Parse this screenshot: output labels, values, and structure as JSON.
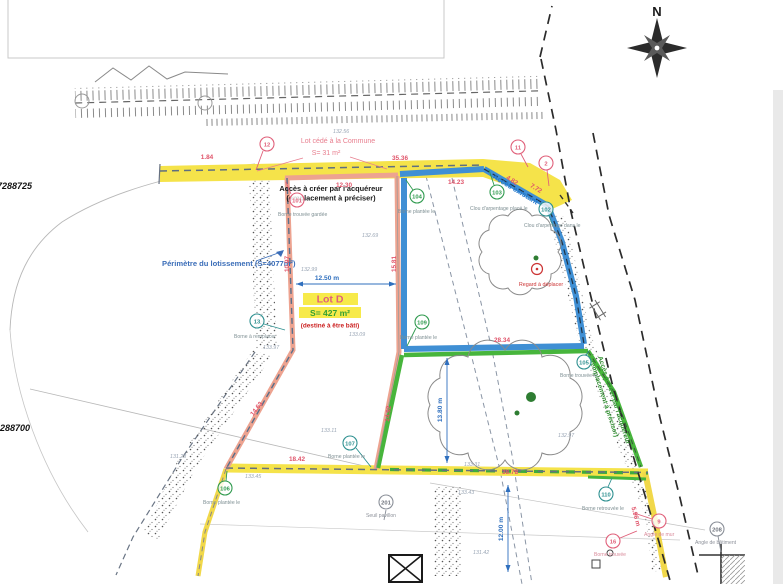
{
  "compass": {
    "north_label": "N"
  },
  "coordinates": {
    "top": "7288725",
    "bottom": "288700"
  },
  "annotations": {
    "lot_cede_1": "Lot cédé à la Commune",
    "lot_cede_2": "S= 31 m²",
    "acces_top_1": "Accès à créer par l'acquéreur",
    "acces_top_2": "(emplacement à préciser)",
    "perimetre": "Périmètre du lotissement (S=4077m²)",
    "lot_d_title": "Lot D",
    "lot_d_area": "S= 427 m²",
    "lot_d_note": "(destiné à être bâti)",
    "acces_right_1": "Accès à créer par l'acquéreur",
    "acces_right_2": "(emplacement à préciser)",
    "acces_existant": "Accès existant",
    "regard": "Regard à déplacer"
  },
  "measurements": [
    "1.84",
    "35.36",
    "12.30",
    "14.23",
    "4.82",
    "7.72",
    "15.81",
    "10.97",
    "28.34",
    "14.92",
    "14.63",
    "18.42",
    "38.78",
    "5.96 m"
  ],
  "measure_blue": [
    "12.50 m",
    "13.80 m",
    "12.00 m"
  ],
  "elevations": [
    "132.56",
    "132.69",
    "132.99",
    "133.09",
    "133.97",
    "133.11",
    "131.28",
    "133.45",
    "133.31",
    "133.43",
    "131.42",
    "132.97"
  ],
  "markers": [
    {
      "num": "12",
      "label": ""
    },
    {
      "num": "11",
      "label": ""
    },
    {
      "num": "2",
      "label": ""
    },
    {
      "num": "101",
      "label": "Borne trouvée gardée"
    },
    {
      "num": "104",
      "label": "Borne plantée le"
    },
    {
      "num": "103",
      "label": "Clou d'arpentage placé le"
    },
    {
      "num": "102",
      "label": "Clou d'arpentage dans le"
    },
    {
      "num": "109",
      "label": "Borne plantée le"
    },
    {
      "num": "13",
      "label": "Borne à remplacer"
    },
    {
      "num": "107",
      "label": "Borne plantée le"
    },
    {
      "num": "106",
      "label": "Borne plantée le"
    },
    {
      "num": "105",
      "label": "Borne trouvée le"
    },
    {
      "num": "110",
      "label": "Borne retrouvée le"
    },
    {
      "num": "9",
      "label": "Angle de mur"
    },
    {
      "num": "16",
      "label": "Borne trouvée"
    },
    {
      "num": "208",
      "label": "Angle de bâtiment"
    },
    {
      "num": "201",
      "label": "Seuil pavillon"
    }
  ],
  "colors": {
    "boundary_salmon": "#eda390",
    "lot_blue": "#3f8fd4",
    "lot_green": "#47b53c",
    "highlight_yellow": "#f5e34a",
    "measure_pink": "#e0546a",
    "measure_blue": "#2f6fbe"
  }
}
